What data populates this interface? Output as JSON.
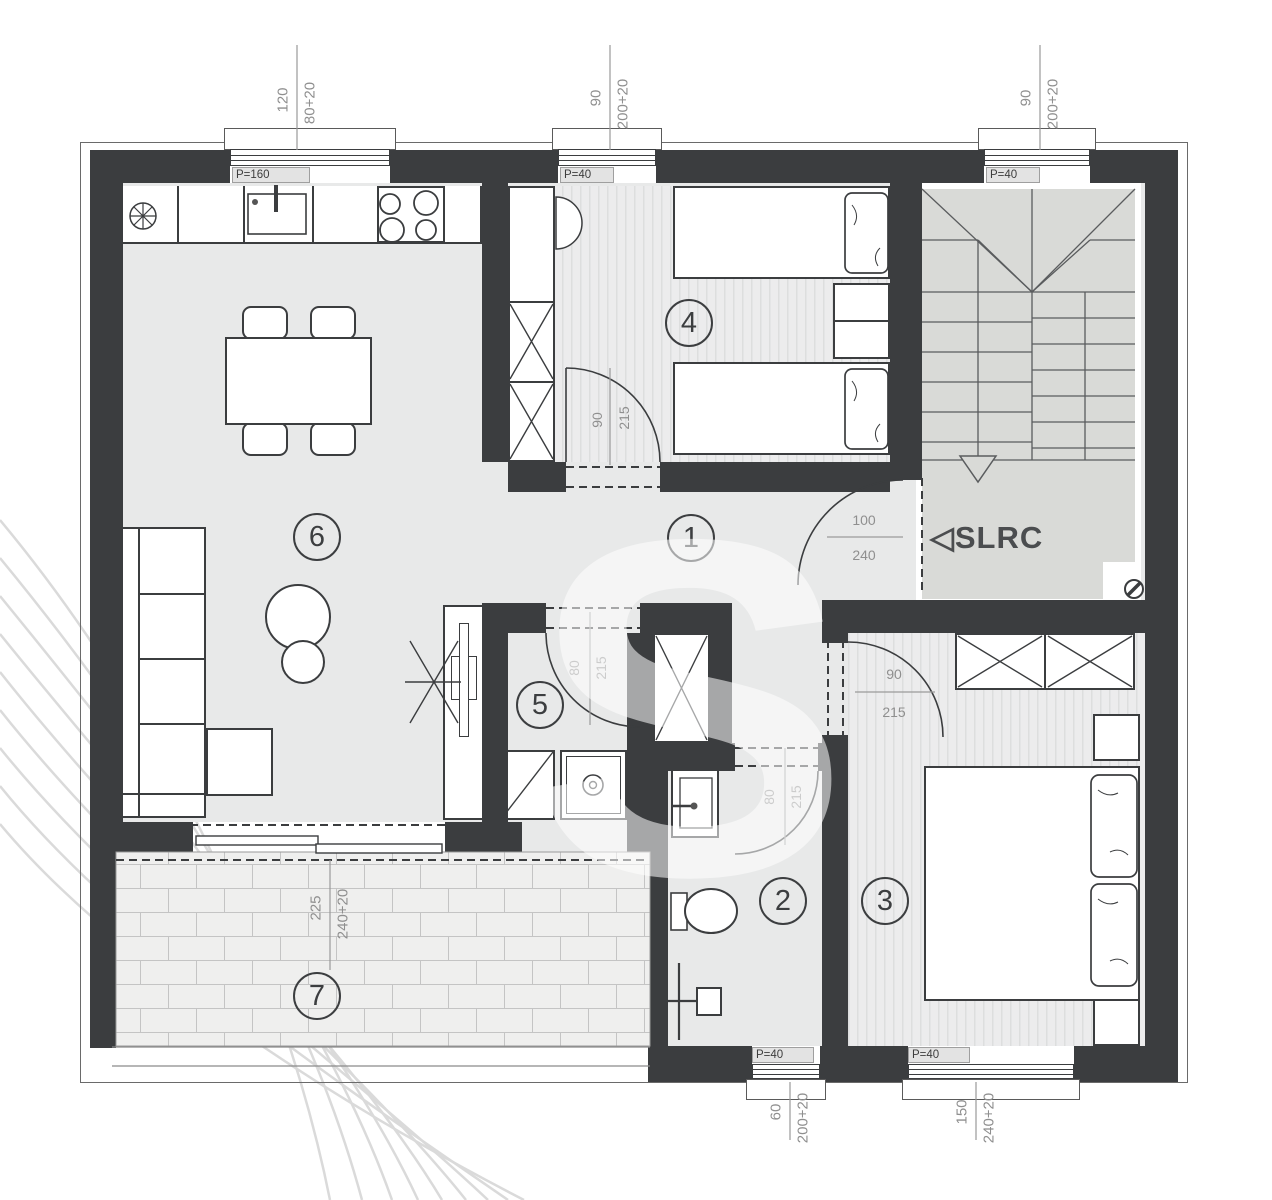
{
  "watermark": {
    "letter": "S"
  },
  "stair": {
    "arrow": "◁",
    "label": "SLRC"
  },
  "rooms": {
    "hall": "1",
    "bath": "2",
    "bedroom_main": "3",
    "bedroom_kids": "4",
    "laundry": "5",
    "living": "6",
    "terrace": "7"
  },
  "windows": {
    "kitchen": {
      "label": "P=160",
      "width": "120",
      "height": "80+20"
    },
    "kids": {
      "label": "P=40",
      "width": "90",
      "height": "200+20"
    },
    "stairs": {
      "label": "P=40",
      "width": "90",
      "height": "200+20"
    },
    "bath": {
      "label": "P=40",
      "width": "60",
      "height": "200+20"
    },
    "main": {
      "label": "P=40",
      "width": "150",
      "height": "240+20"
    }
  },
  "doors": {
    "kids": {
      "width": "90",
      "height": "215"
    },
    "entry": {
      "width": "100",
      "height": "240"
    },
    "laundry": {
      "width": "80",
      "height": "215"
    },
    "bath": {
      "width": "80",
      "height": "215"
    },
    "main": {
      "width": "90",
      "height": "215"
    },
    "terrace": {
      "width": "225",
      "height": "240+20"
    }
  }
}
